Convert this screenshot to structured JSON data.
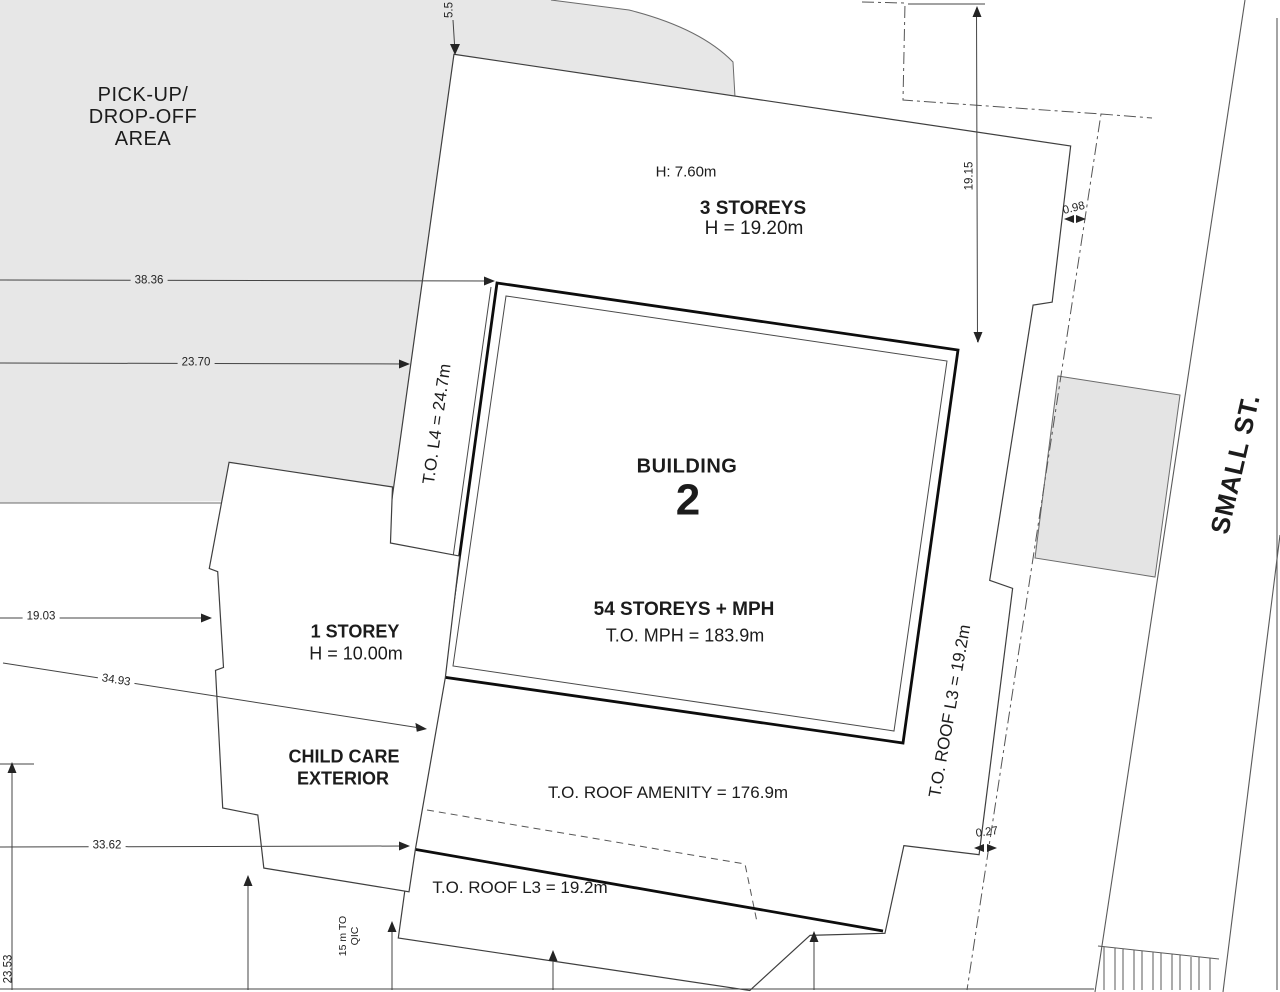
{
  "drawing": {
    "type": "architectural-site-plan",
    "street_name": "SMALL ST."
  },
  "labels": {
    "pickup_area": [
      "PICK-UP/",
      "DROP-OFF",
      "AREA"
    ],
    "h_roof_note": "H: 7.60m",
    "three_storeys": "3 STOREYS",
    "three_storeys_height": "H = 19.20m",
    "building_word": "BUILDING",
    "building_number": "2",
    "storeys_54": "54 STOREYS + MPH",
    "to_mph": "T.O. MPH = 183.9m",
    "to_l4": "T.O. L4 = 24.7m",
    "one_storey": "1 STOREY",
    "one_storey_height": "H = 10.00m",
    "child_care_line1": "CHILD CARE",
    "child_care_line2": "EXTERIOR",
    "to_roof_amenity": "T.O. ROOF AMENITY = 176.9m",
    "to_roof_l3_bottom": "T.O. ROOF L3 = 19.2m",
    "to_roof_l3_right": "T.O. ROOF L3 = 19.2m",
    "street": "SMALL ST."
  },
  "dimensions": {
    "d_5_5": "5.5",
    "d_38_36": "38.36",
    "d_23_70": "23.70",
    "d_19_03": "19.03",
    "d_34_93": "34.93",
    "d_33_62": "33.62",
    "d_23_53": "23.53",
    "d_19_15": "19.15",
    "d_0_98": "0.98",
    "d_0_27": "0.27",
    "qic_line1": "15 m TO",
    "qic_line2": "QIC"
  },
  "colors": {
    "background": "#ffffff",
    "area_fill": "#e7e7e7",
    "thin_line": "#4a4a4a",
    "bold_line": "#0d0d0d",
    "text": "#1c1c1c"
  }
}
